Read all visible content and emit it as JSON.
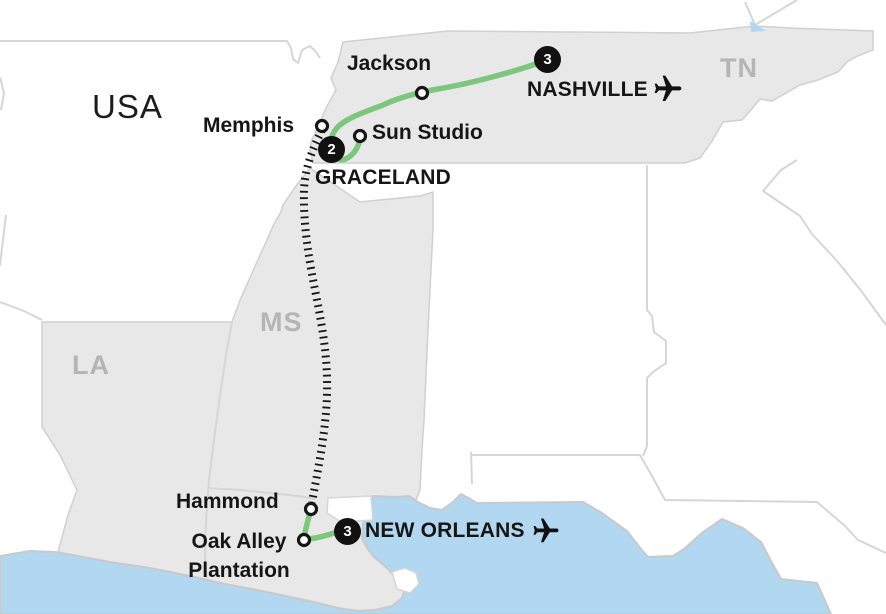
{
  "map": {
    "country_label": "USA",
    "state_labels": {
      "tennessee": "TN",
      "mississippi": "MS",
      "louisiana": "LA"
    },
    "locations": {
      "nashville": {
        "label": "NASHVILLE",
        "nights": "3",
        "has_airport": true
      },
      "jackson": {
        "label": "Jackson"
      },
      "memphis": {
        "label": "Memphis"
      },
      "sun_studio": {
        "label": "Sun Studio"
      },
      "graceland": {
        "label": "GRACELAND",
        "nights": "2"
      },
      "hammond": {
        "label": "Hammond"
      },
      "oak_alley": {
        "label_line1": "Oak Alley",
        "label_line2": "Plantation"
      },
      "new_orleans": {
        "label": "NEW ORLEANS",
        "nights": "3",
        "has_airport": true
      }
    },
    "icons": {
      "airport": "airplane-icon",
      "overnight_stop": "night-count-badge",
      "visit_stop": "stop-circle"
    },
    "colors": {
      "route_green": "#7dc67e",
      "rail_black": "#161616",
      "water_blue": "#b1d7f1",
      "highlight_state_fill": "#e8e8e9",
      "state_border": "#d0d0d0",
      "state_label_gray": "#b5b5b5",
      "badge_black": "#111111",
      "label_text": "#161616"
    }
  }
}
